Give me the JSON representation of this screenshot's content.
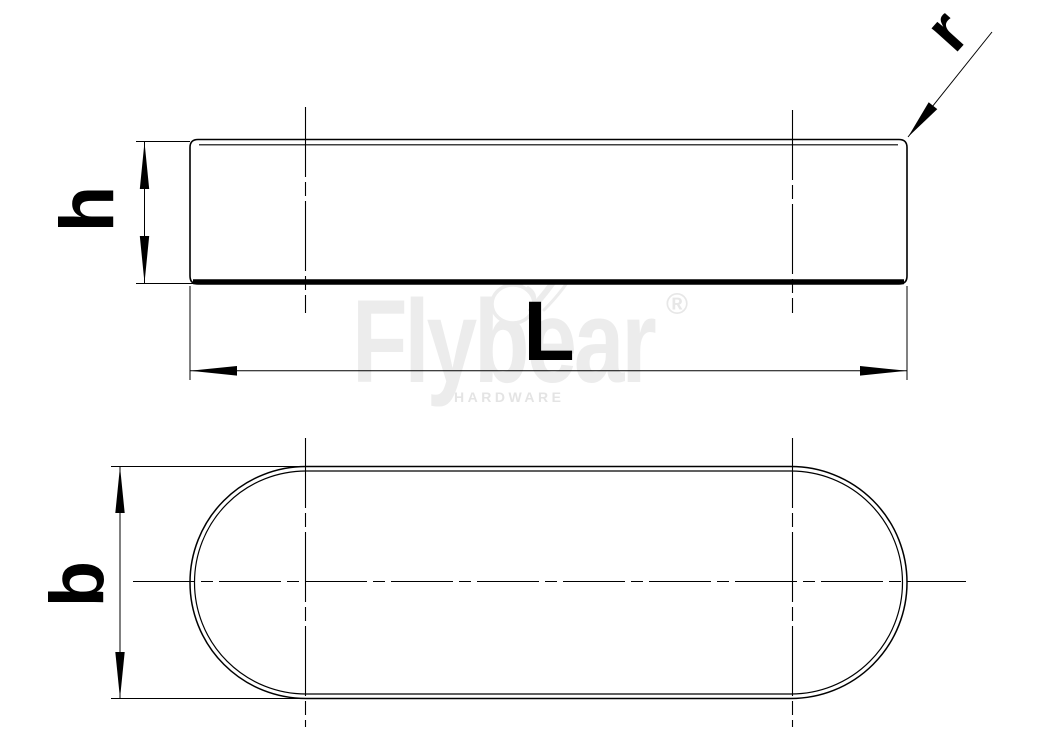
{
  "drawing": {
    "dimension_labels": {
      "height": "h",
      "length": "L",
      "width": "b",
      "chamfer_radius": "r"
    },
    "watermark": {
      "brand": "Flybear",
      "subtitle": "HARDWARE",
      "registered_mark": "®"
    },
    "colors": {
      "line": "#000000",
      "background": "#ffffff",
      "watermark_gray": "#ececec"
    }
  }
}
